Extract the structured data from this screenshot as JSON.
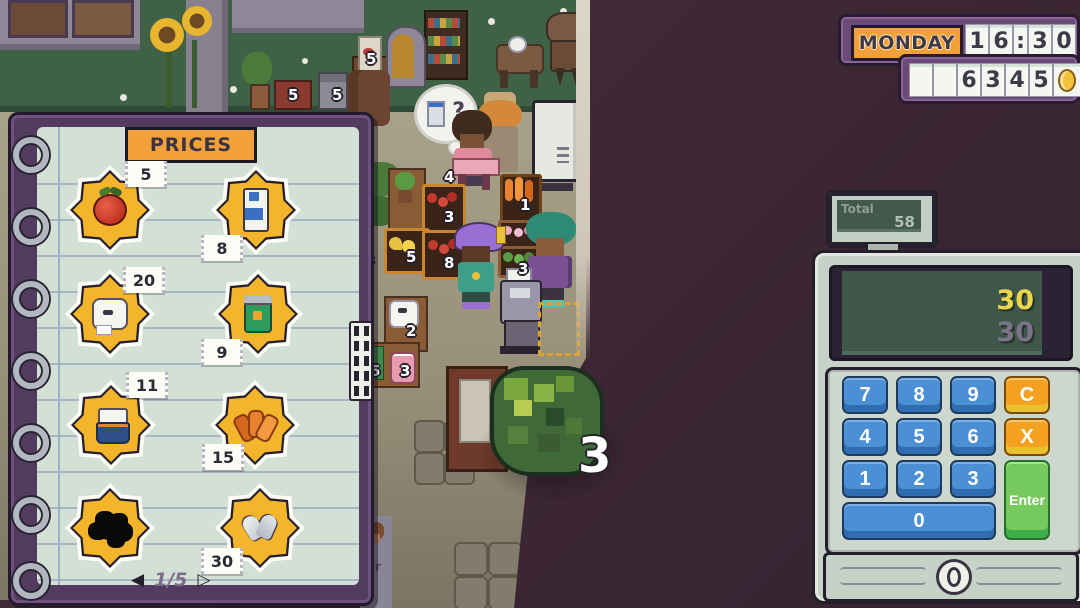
{
  "clock": {
    "day": "MONDAY",
    "time_digits": [
      "1",
      "6",
      ":",
      "3",
      "0"
    ],
    "money_digits": [
      "",
      "",
      "6",
      "3",
      "4",
      "5"
    ],
    "coin_icon": "coin"
  },
  "notebook": {
    "title": "PRICES",
    "items": [
      {
        "icon": "apple",
        "price": "5"
      },
      {
        "icon": "milk-carton",
        "price": "8"
      },
      {
        "icon": "toilet-paper",
        "price": "20"
      },
      {
        "icon": "soda-can",
        "price": "9"
      },
      {
        "icon": "noodle-cup",
        "price": "11"
      },
      {
        "icon": "fried-snack",
        "price": "15"
      },
      {
        "icon": "unknown-item",
        "price": ""
      },
      {
        "icon": "silver-heart",
        "price": "30"
      }
    ],
    "pagination": {
      "prev_arrow": "◀",
      "current": "1/5",
      "next_arrow": "▷"
    }
  },
  "register": {
    "total_label": "Total",
    "total_value": "58",
    "screen_line1": "30",
    "screen_line2": "30",
    "keypad": {
      "key7": "7",
      "key8": "8",
      "key9": "9",
      "clear": "C",
      "key4": "4",
      "key5": "5",
      "key6": "6",
      "multiply": "X",
      "key1": "1",
      "key2": "2",
      "key3": "3",
      "key0": "0",
      "enter": "Enter"
    }
  },
  "scene": {
    "thought_mark": "?",
    "held_item_count": "3",
    "poster_fragment": "er",
    "stock_labels": [
      "5",
      "5",
      "5",
      "4",
      "3",
      "1",
      "5",
      "8",
      "3",
      "3",
      "2",
      "5",
      "3"
    ]
  }
}
